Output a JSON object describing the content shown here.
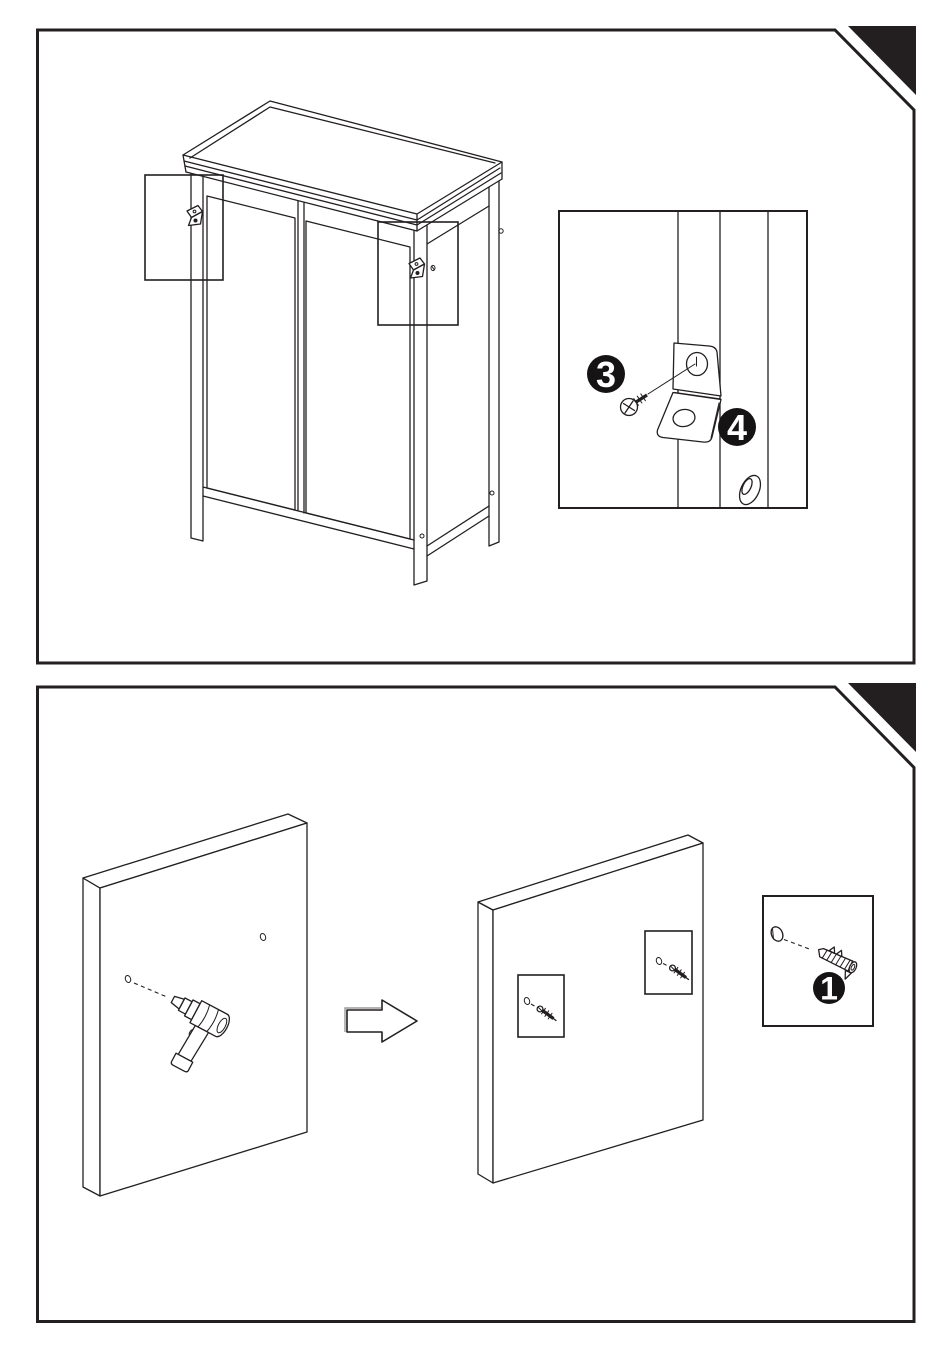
{
  "page": {
    "background": "#ffffff",
    "ink": "#231f20",
    "badge_bg": "#161314",
    "badge_text": "#ffffff"
  },
  "top_step": {
    "screw_badge": "3",
    "bracket_badge": "4",
    "parts": [
      "cabinet",
      "l-bracket",
      "mounting-screw",
      "keyhole-slot"
    ]
  },
  "bottom_step": {
    "anchor_badge": "1",
    "parts": [
      "wall-panel",
      "power-drill",
      "direction-arrow",
      "anchor-screw",
      "wall-anchor"
    ]
  }
}
